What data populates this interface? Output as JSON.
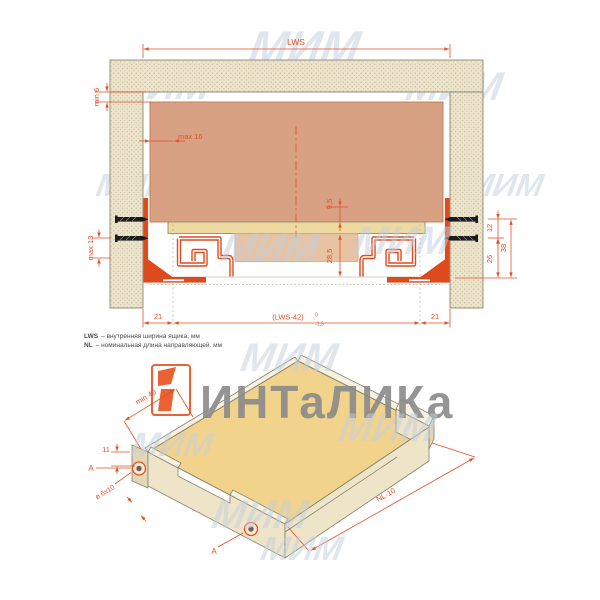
{
  "section": {
    "lws": "LWS",
    "min6": "min 6",
    "max16": "max 16",
    "h95": "9,5",
    "h285": "28,5",
    "max13": "max 13",
    "s12": "12",
    "s26": "26",
    "s38": "38",
    "off21l": "21",
    "span": "(LWS-42)",
    "tolUp": "0",
    "tolDn": "-1,5",
    "off21r": "21"
  },
  "legend": {
    "t1": "LWS",
    "d1": "– внутренняя ширина ящика, мм",
    "t2": "NL",
    "d2": "– номинальная длина направляющей, мм"
  },
  "iso": {
    "min40": "min 40",
    "e11": "11",
    "hole": "ø 6x10",
    "nl": "NL-10",
    "a": "A"
  },
  "brand": {
    "name": "ИНТаЛИКа",
    "mim": "МИМ"
  },
  "colors": {
    "dimension": "#e2512a",
    "slide": "#dd4a1b",
    "panelWood": "#ece3cb",
    "drawerBack": "#d9a184",
    "drawerBottom": "#eedaa0",
    "isoTop": "#f2d38b",
    "watermark": "#c3cfdf",
    "brandGrey": "#8a8a8a",
    "logoOrange": "#e8501e"
  }
}
